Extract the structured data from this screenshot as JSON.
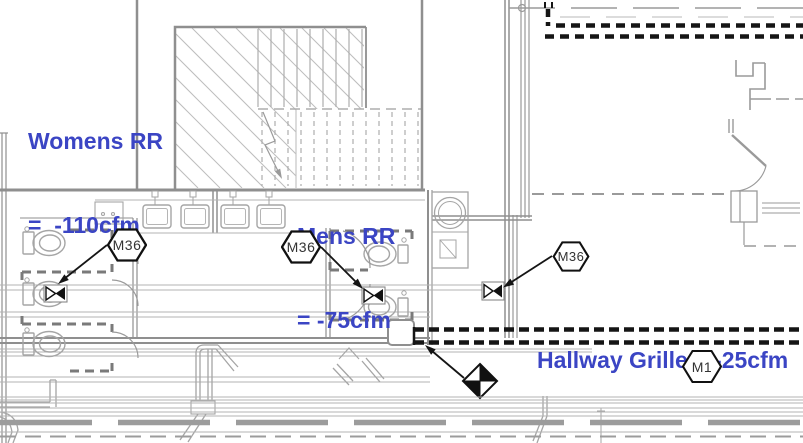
{
  "annotations": {
    "womens_rr": {
      "line1": "Womens RR",
      "line2": "=  -110cfm"
    },
    "mens_rr": {
      "line1": "Mens RR",
      "line2": "= -75cfm"
    },
    "hallway_grille": {
      "label": "Hallway Grille = -25cfm"
    }
  },
  "tags": [
    {
      "label": "M36"
    },
    {
      "label": "M36"
    },
    {
      "label": "M36"
    },
    {
      "label": "M1"
    }
  ],
  "colors": {
    "annotation_blue": "#3b45c4",
    "duct_black": "#151515",
    "wall_gray": "#8f8f8f",
    "fixture_gray": "#a5a5a5",
    "hatch_gray": "#bdbdbd",
    "tag_text": "#333333"
  }
}
